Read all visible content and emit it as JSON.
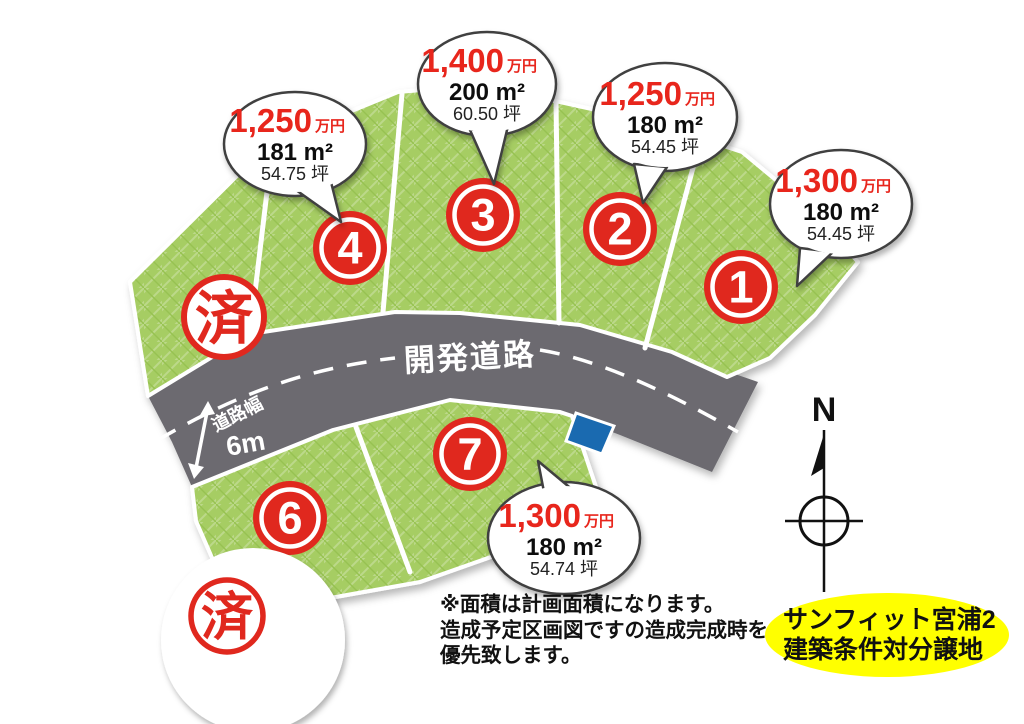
{
  "title": {
    "line1": "サンフィット宮浦2",
    "line2": "建築条件対分譲地"
  },
  "note": {
    "line1": "※面積は計画面積になります。",
    "line2": "造成予定区画図ですの造成完成時を",
    "line3": "優先致します。"
  },
  "road": {
    "name": "開発道路",
    "width_label": "道路幅",
    "width_value": "6m"
  },
  "compass": {
    "north_label": "N"
  },
  "sold_stamp_label": "済",
  "plots": {
    "p1": {
      "number": "1",
      "price": "1,300",
      "price_unit": "万円",
      "area_m2": "180 m²",
      "area_tsubo": "54.45 坪"
    },
    "p2": {
      "number": "2",
      "price": "1,250",
      "price_unit": "万円",
      "area_m2": "180 m²",
      "area_tsubo": "54.45 坪"
    },
    "p3": {
      "number": "3",
      "price": "1,400",
      "price_unit": "万円",
      "area_m2": "200 m²",
      "area_tsubo": "60.50 坪"
    },
    "p4": {
      "number": "4",
      "price": "1,250",
      "price_unit": "万円",
      "area_m2": "181 m²",
      "area_tsubo": "54.75 坪"
    },
    "p6": {
      "number": "6"
    },
    "p7": {
      "number": "7",
      "price": "1,300",
      "price_unit": "万円",
      "area_m2": "180 m²",
      "area_tsubo": "54.74 坪"
    }
  },
  "colors": {
    "green": "#a6cd64",
    "green_light": "#bcd98a",
    "green_dark": "#97c251",
    "road_gray": "#6c6b70",
    "stamp_red": "#e0281e",
    "price_red": "#e8251d",
    "water_blue": "#1a6ab0",
    "highlight_yellow": "#ffff00"
  }
}
